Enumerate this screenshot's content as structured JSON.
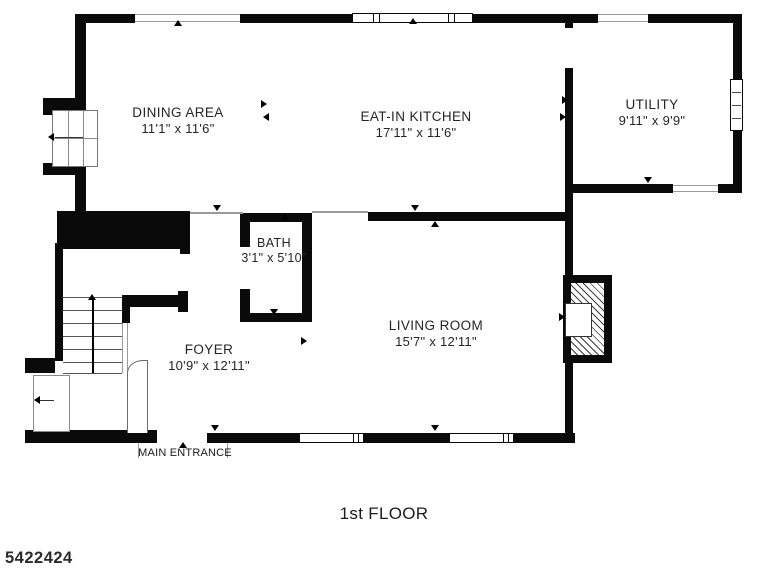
{
  "floor_plan": {
    "rooms": [
      {
        "name": "DINING AREA",
        "dims": "11'1\" x 11'6\""
      },
      {
        "name": "EAT-IN KITCHEN",
        "dims": "17'11\" x 11'6\""
      },
      {
        "name": "UTILITY",
        "dims": "9'11\" x 9'9\""
      },
      {
        "name": "BATH",
        "dims": "3'1\" x 5'10\""
      },
      {
        "name": "LIVING ROOM",
        "dims": "15'7\" x 12'11\""
      },
      {
        "name": "FOYER",
        "dims": "10'9\" x 12'11\""
      }
    ],
    "labels": {
      "main_entrance": "MAIN ENTRANCE",
      "floor_title": "1st FLOOR",
      "listing_number": "5422424"
    },
    "colors": {
      "wall": "#0a0a0a",
      "thin_line": "#9a9a9a",
      "text": "#252525",
      "background": "#ffffff"
    }
  }
}
